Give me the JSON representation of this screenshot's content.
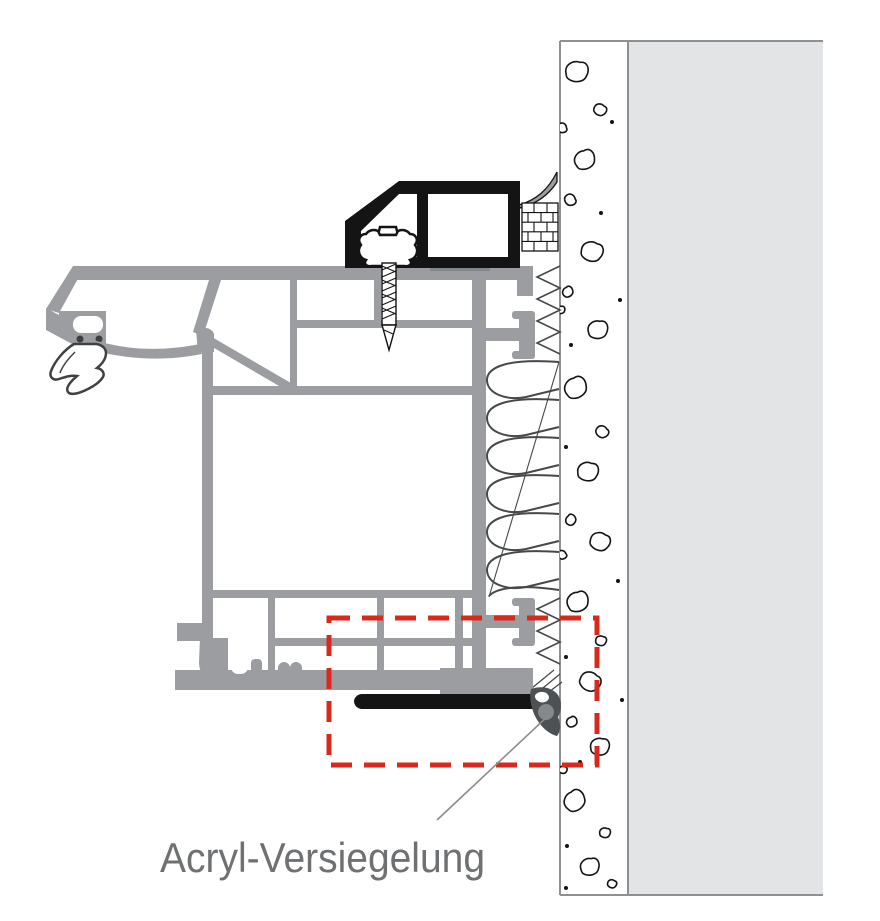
{
  "diagram": {
    "label": "Acryl-Versiegelung",
    "label_pos": {
      "x": 160,
      "y": 872
    },
    "highlight_box": {
      "x": 329,
      "y": 618,
      "width": 268,
      "height": 147
    },
    "colors": {
      "frame_gray": "#9b9da0",
      "outline_dark": "#141414",
      "wall_plaster": "#e3e4e6",
      "wall_border": "#8e9092",
      "concrete_white": "#ffffff",
      "insulation_line": "#46484a",
      "highlight_red": "#da291c",
      "label_gray": "#6e7072",
      "seal_dark": "#4e5154",
      "seal_mid": "#85888a",
      "leader_gray": "#8a8c8e"
    }
  }
}
